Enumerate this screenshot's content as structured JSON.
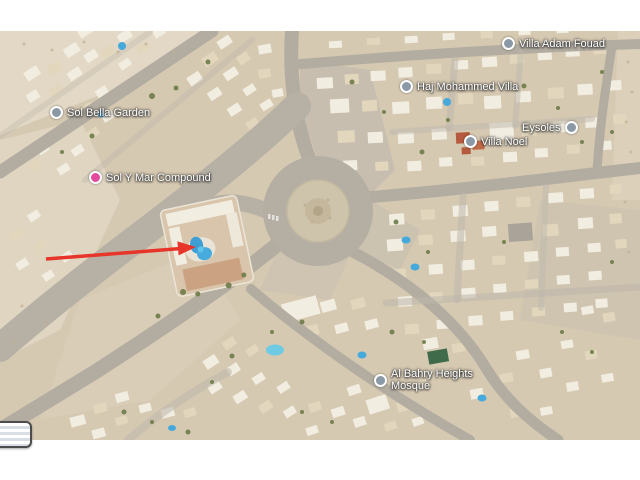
{
  "map": {
    "view": "satellite",
    "labels": [
      {
        "name": "sol-bella-garden",
        "text": "Sol Bella Garden",
        "icon": "poi-icon",
        "icon_color": "#8b98a6"
      },
      {
        "name": "sol-y-mar-compound",
        "text": "Sol Y Mar Compound",
        "icon": "lodging-icon",
        "icon_color": "#e24b9d"
      },
      {
        "name": "haj-mohammed-villa",
        "text": "Haj Mohammed Villa",
        "icon": "poi-icon",
        "icon_color": "#8b98a6"
      },
      {
        "name": "villa-adam-fouad",
        "text": "Villa Adam Fouad",
        "icon": "poi-icon",
        "icon_color": "#8b98a6"
      },
      {
        "name": "eysoles",
        "text": "Eysoles",
        "icon": "poi-icon",
        "icon_color": "#8b98a6"
      },
      {
        "name": "villa-noel",
        "text": "Villa Noel",
        "icon": "poi-icon",
        "icon_color": "#8b98a6"
      },
      {
        "name": "al-bahry-heights-mosque",
        "text": "Al Bahry Heights",
        "text2": "Mosque",
        "icon": "poi-icon",
        "icon_color": "#8b98a6"
      }
    ],
    "annotation_arrow": {
      "color": "#e8352a",
      "points_to": "compound swimming pool"
    },
    "colors": {
      "sand": "#d6c9b2",
      "road": "#b3ada1",
      "pool": "#45a9dc",
      "label_text": "#ffffff"
    }
  }
}
